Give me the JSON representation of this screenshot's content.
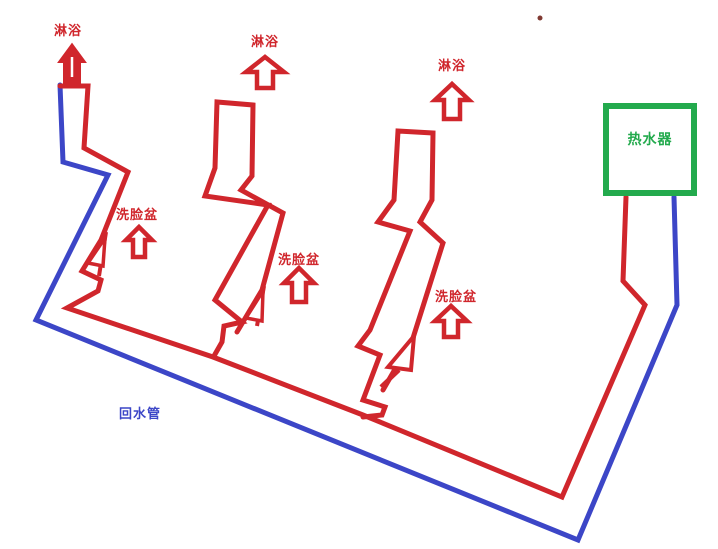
{
  "diagram": {
    "heater": {
      "label": "热水器"
    },
    "return_pipe": {
      "label": "回水管"
    },
    "showers": [
      {
        "label": "淋浴"
      },
      {
        "label": "淋浴"
      },
      {
        "label": "淋浴"
      }
    ],
    "basins": [
      {
        "label": "洗脸盆"
      },
      {
        "label": "洗脸盆"
      },
      {
        "label": "洗脸盆"
      }
    ],
    "icons": {
      "shower_arrows": "up-arrow",
      "basin_arrows": "up-arrow",
      "valve_flags": "triangle-flag"
    },
    "colors": {
      "hot_water": "#d0262c",
      "return_water": "#3c46c7",
      "heater_green": "#23aa4d",
      "stray_mark": "#803a32",
      "background": "#ffffff"
    }
  }
}
